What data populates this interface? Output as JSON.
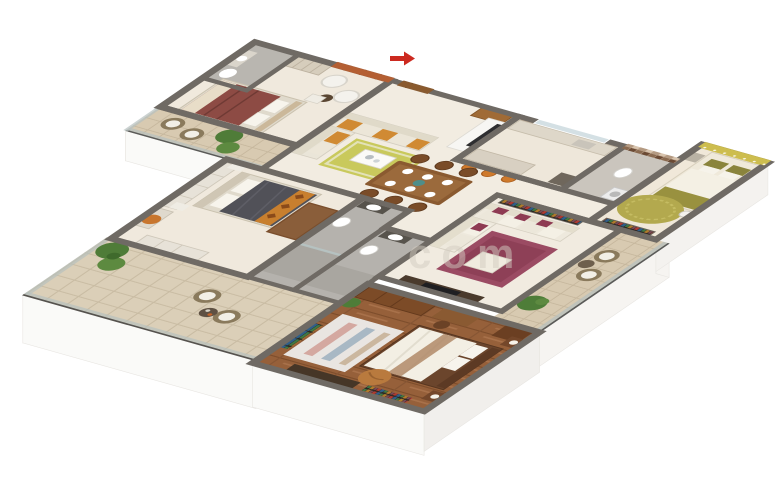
{
  "scene": {
    "type": "3d-isometric-floor-plan-render",
    "background": "#ffffff",
    "watermark_text": "com",
    "entrance_marker": "red-arrow"
  },
  "palette": {
    "wall_cap": "#6f6a64",
    "floor_cream": "#f0e9dd",
    "floor_marble": "#f2ece1",
    "bath_floor": "#b5b2ad",
    "wood_floor": "#96603a",
    "terrace_tile": "#dbcfb8",
    "accent_orange_wall": "#b45f33",
    "accent_yellow_wall": "#cdbd4e",
    "sofa_cream": "#eae5d8",
    "cushion_orange": "#d08a33",
    "maroon": "#8e3a52",
    "rug_olive": "#b3a94e",
    "rug_maroon": "#9b4b63",
    "rug_yellow_green": "#c9c95c",
    "dining_wood": "#8a5a30",
    "dark_bed": "#515158",
    "plant_green": "#4f7c38",
    "entrance_red": "#cc2a20",
    "glass_rail": "#b6c0bf",
    "exterior_fascia": "#fafaf8"
  }
}
